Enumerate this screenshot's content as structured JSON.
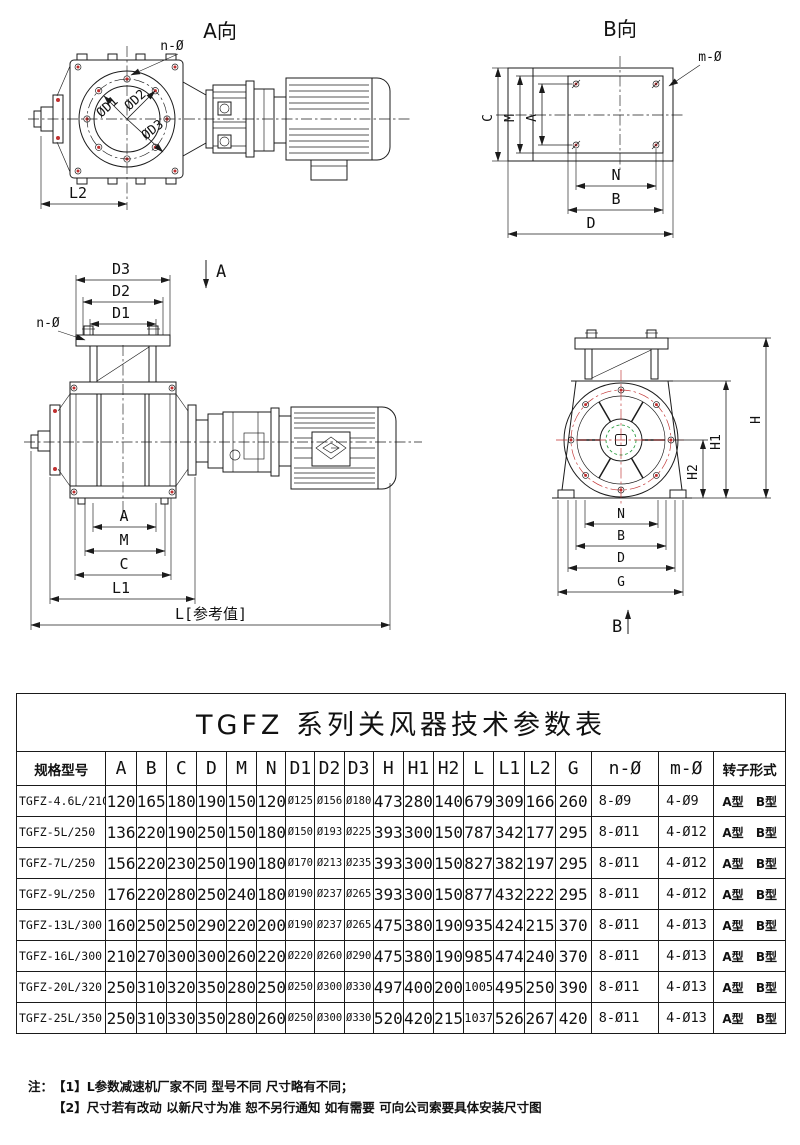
{
  "drawings": {
    "view_a": {
      "title": "A向",
      "labels": {
        "n_hole": "n-Ø",
        "d1": "ØD1",
        "d2": "ØD2",
        "d3": "ØD3",
        "l2": "L2"
      }
    },
    "view_b": {
      "title": "B向",
      "labels": {
        "m_hole": "m-Ø",
        "c": "C",
        "m": "M",
        "a": "A",
        "n": "N",
        "b": "B",
        "d": "D"
      }
    },
    "front_view": {
      "labels": {
        "d3": "D3",
        "d2": "D2",
        "d1": "D1",
        "n_hole": "n-Ø",
        "section_a": "A",
        "a": "A",
        "m": "M",
        "c": "C",
        "l1": "L1",
        "l_ref": "L[参考值]"
      }
    },
    "end_view": {
      "labels": {
        "h": "H",
        "h1": "H1",
        "h2": "H2",
        "n": "N",
        "b": "B",
        "d": "D",
        "g": "G",
        "section_b": "B"
      }
    }
  },
  "table": {
    "title": "TGFZ 系列关风器技术参数表",
    "columns": [
      "规格型号",
      "A",
      "B",
      "C",
      "D",
      "M",
      "N",
      "D1",
      "D2",
      "D3",
      "H",
      "H1",
      "H2",
      "L",
      "L1",
      "L2",
      "G",
      "n-Ø",
      "m-Ø",
      "转子形式"
    ],
    "rows": [
      [
        "TGFZ-4.6L/210",
        "120",
        "165",
        "180",
        "190",
        "150",
        "120",
        "Ø125",
        "Ø156",
        "Ø180",
        "473",
        "280",
        "140",
        "679",
        "309",
        "166",
        "260",
        "8-Ø9",
        "4-Ø9",
        "A型 B型"
      ],
      [
        "TGFZ-5L/250",
        "136",
        "220",
        "190",
        "250",
        "150",
        "180",
        "Ø150",
        "Ø193",
        "Ø225",
        "393",
        "300",
        "150",
        "787",
        "342",
        "177",
        "295",
        "8-Ø11",
        "4-Ø12",
        "A型 B型"
      ],
      [
        "TGFZ-7L/250",
        "156",
        "220",
        "230",
        "250",
        "190",
        "180",
        "Ø170",
        "Ø213",
        "Ø235",
        "393",
        "300",
        "150",
        "827",
        "382",
        "197",
        "295",
        "8-Ø11",
        "4-Ø12",
        "A型 B型"
      ],
      [
        "TGFZ-9L/250",
        "176",
        "220",
        "280",
        "250",
        "240",
        "180",
        "Ø190",
        "Ø237",
        "Ø265",
        "393",
        "300",
        "150",
        "877",
        "432",
        "222",
        "295",
        "8-Ø11",
        "4-Ø12",
        "A型 B型"
      ],
      [
        "TGFZ-13L/300",
        "160",
        "250",
        "250",
        "290",
        "220",
        "200",
        "Ø190",
        "Ø237",
        "Ø265",
        "475",
        "380",
        "190",
        "935",
        "424",
        "215",
        "370",
        "8-Ø11",
        "4-Ø13",
        "A型 B型"
      ],
      [
        "TGFZ-16L/300",
        "210",
        "270",
        "300",
        "300",
        "260",
        "220",
        "Ø220",
        "Ø260",
        "Ø290",
        "475",
        "380",
        "190",
        "985",
        "474",
        "240",
        "370",
        "8-Ø11",
        "4-Ø13",
        "A型 B型"
      ],
      [
        "TGFZ-20L/320",
        "250",
        "310",
        "320",
        "350",
        "280",
        "250",
        "Ø250",
        "Ø300",
        "Ø330",
        "497",
        "400",
        "200",
        "1005",
        "495",
        "250",
        "390",
        "8-Ø11",
        "4-Ø13",
        "A型 B型"
      ],
      [
        "TGFZ-25L/350",
        "250",
        "310",
        "330",
        "350",
        "280",
        "260",
        "Ø250",
        "Ø300",
        "Ø330",
        "520",
        "420",
        "215",
        "1037",
        "526",
        "267",
        "420",
        "8-Ø11",
        "4-Ø13",
        "A型 B型"
      ]
    ]
  },
  "notes": {
    "prefix": "注：",
    "items": [
      "【1】L参数减速机厂家不同 型号不同 尺寸略有不同；",
      "【2】尺寸若有改动 以新尺寸为准 恕不另行通知 如有需要 可向公司索要具体安装尺寸图"
    ]
  },
  "colors": {
    "line": "#1b1b1b",
    "accent_red": "#c03030",
    "accent_green": "#2f9e44"
  }
}
